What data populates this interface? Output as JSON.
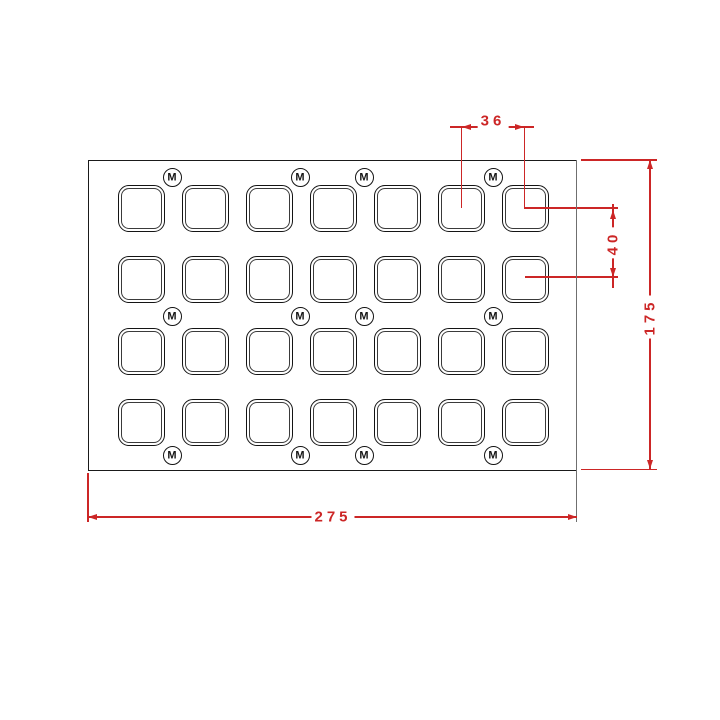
{
  "drawing": {
    "kind": "technical-drawing",
    "grid": {
      "cols": 7,
      "rows": 4,
      "cavity_count": 28
    },
    "marker_label": "M",
    "marker_count": 12
  },
  "dimensions": {
    "pitch_x": "36",
    "pitch_y": "40",
    "plate_width": "275",
    "plate_height": "175"
  },
  "colors": {
    "dimension_red": "#cc2626",
    "outline_black": "#1a1a1a",
    "extension_gray": "#6f6f6f",
    "background": "#ffffff"
  }
}
